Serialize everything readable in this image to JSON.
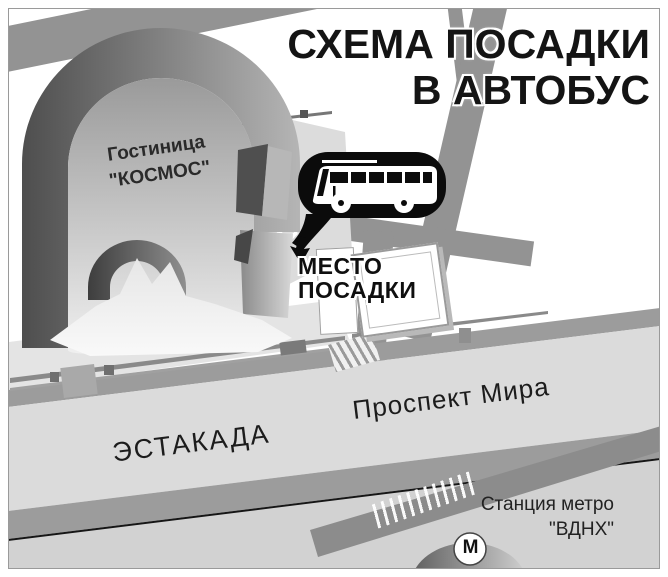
{
  "title": {
    "line1": "СХЕМА ПОСАДКИ",
    "line2": "В АВТОБУС"
  },
  "hotel": {
    "name_line1": "Гостиница",
    "name_line2": "\"КОСМОС\""
  },
  "boarding_point": {
    "line1": "МЕСТО",
    "line2": "ПОСАДКИ"
  },
  "roads": {
    "overpass": "ЭСТАКАДА",
    "avenue": "Проспект Мира"
  },
  "metro": {
    "station_line1": "Станция метро",
    "station_line2": "\"ВДНХ\"",
    "logo_letter": "М"
  },
  "icons": {
    "bus": "bus-icon",
    "callout": "speech-bubble-with-arrow",
    "metro_logo": "metro-m-icon"
  },
  "colors": {
    "road": "#939393",
    "roadway_light": "#dbdbdb",
    "roadway_edge": "#9c9c9c",
    "ground": "#d2d2d2",
    "callout_black": "#0b0b0b",
    "building_dark": "#4e4e4e",
    "building_light": "#f0f0f0"
  }
}
